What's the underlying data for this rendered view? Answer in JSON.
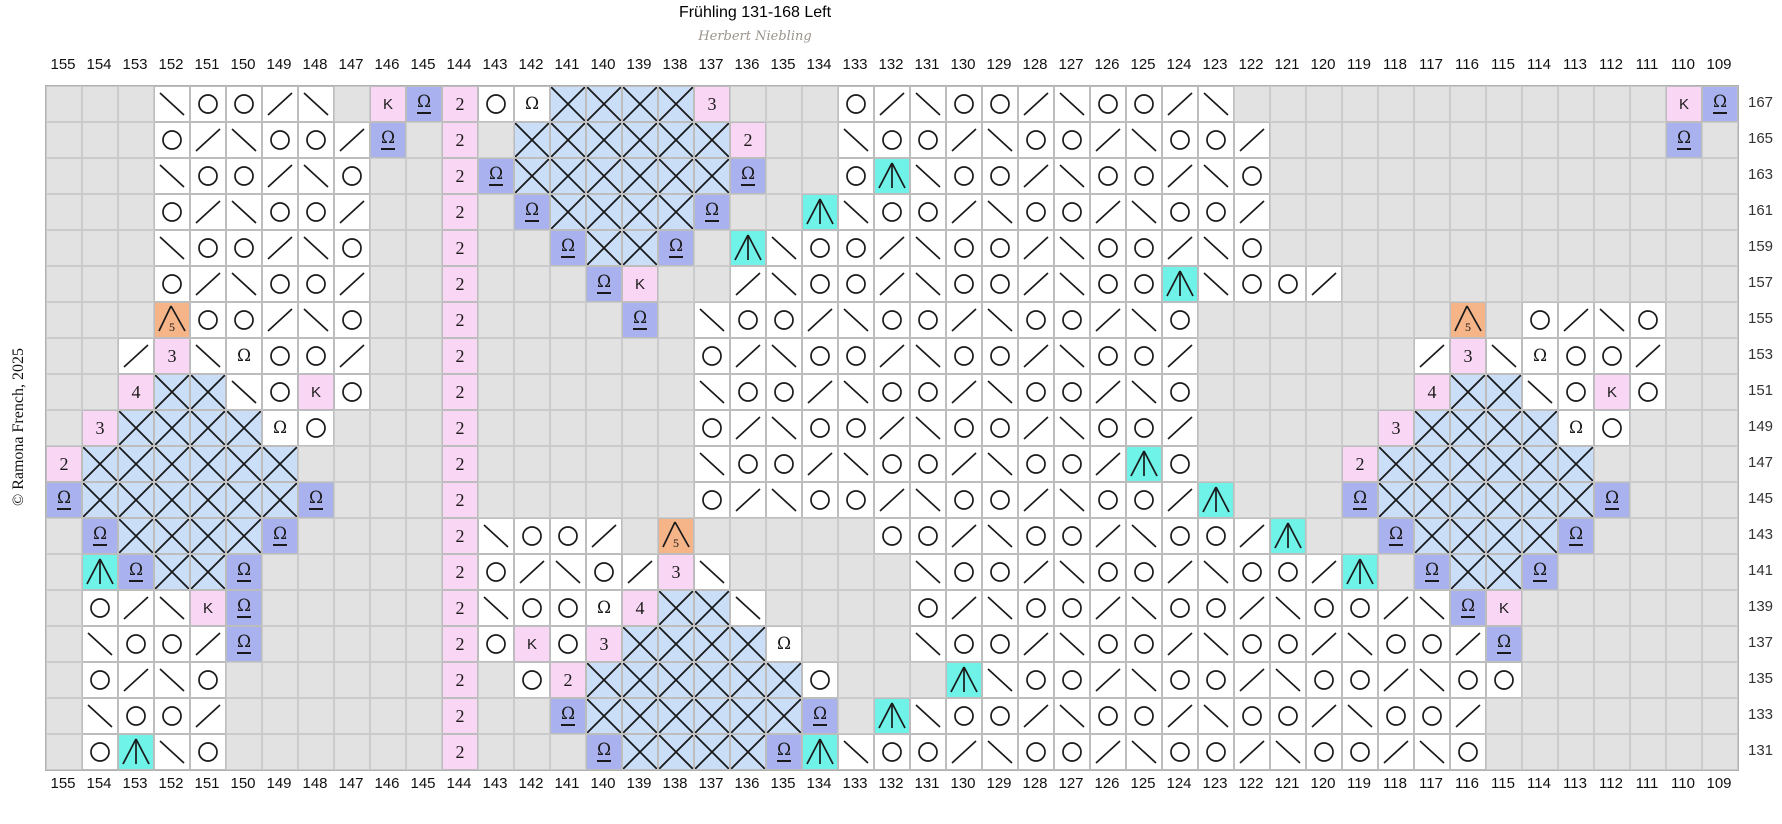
{
  "title": "Frühling 131-168 Left",
  "subtitle": "Herbert Niebling",
  "copyright": "© Ramona French, 2025",
  "chart_data": {
    "type": "heatmap",
    "description": "Lace knitting chart grid; odd-numbered right-side rows 167 down to 131, stitch columns 155 down to 109",
    "columns": [
      155,
      154,
      153,
      152,
      151,
      150,
      149,
      148,
      147,
      146,
      145,
      144,
      143,
      142,
      141,
      140,
      139,
      138,
      137,
      136,
      135,
      134,
      133,
      132,
      131,
      130,
      129,
      128,
      127,
      126,
      125,
      124,
      123,
      122,
      121,
      120,
      119,
      118,
      117,
      116,
      115,
      114,
      113,
      112,
      111,
      110,
      109
    ],
    "row_numbers": [
      167,
      165,
      163,
      161,
      159,
      157,
      155,
      153,
      151,
      149,
      147,
      145,
      143,
      141,
      139,
      137,
      135,
      133,
      131
    ],
    "legend": {
      "g": "no stitch (gray)",
      "bs": "left-leaning decrease \\",
      "fs": "right-leaning decrease /",
      "o": "yarn over O",
      "A": "centered double decrease (cyan)",
      "W": "twisted stitch omega (periwinkle)",
      "Q": "twisted stitch omega (white)",
      "K": "K stitch (pink)",
      "2": "repeat number 2 (pink)",
      "3": "repeat number 3 (pink)",
      "4": "repeat number 4 (pink)",
      "5": "5-into-1 gathered stitch (orange)",
      "X": "crossed-stitch lattice (light blue)"
    },
    "colors": {
      "no_stitch": "#e2e2e2",
      "pink": "#f9d6f3",
      "periwinkle": "#a9b2ee",
      "cyan": "#6ff3e9",
      "orange": "#f6b588",
      "lattice_blue": "#cadef8",
      "stroke": "#1a1a1a",
      "grid_line": "#bdbdbd"
    },
    "rows": [
      [
        "g",
        "g",
        "g",
        "bs",
        "o",
        "o",
        "fs",
        "bs",
        "g",
        "K",
        "W",
        "2",
        "o",
        "Q",
        "X",
        "X",
        "X",
        "X",
        "3",
        "g",
        "g",
        "g",
        "o",
        "fs",
        "bs",
        "o",
        "o",
        "fs",
        "bs",
        "o",
        "o",
        "fs",
        "bs",
        "g",
        "g",
        "g",
        "g",
        "g",
        "g",
        "g",
        "g",
        "g",
        "g",
        "g",
        "g",
        "K",
        "W"
      ],
      [
        "g",
        "g",
        "g",
        "o",
        "fs",
        "bs",
        "o",
        "o",
        "fs",
        "W",
        "g",
        "2",
        "g",
        "X",
        "X",
        "X",
        "X",
        "X",
        "X",
        "2",
        "g",
        "g",
        "bs",
        "o",
        "o",
        "fs",
        "bs",
        "o",
        "o",
        "fs",
        "bs",
        "o",
        "o",
        "fs",
        "g",
        "g",
        "g",
        "g",
        "g",
        "g",
        "g",
        "g",
        "g",
        "g",
        "g",
        "W",
        "g"
      ],
      [
        "g",
        "g",
        "g",
        "bs",
        "o",
        "o",
        "fs",
        "bs",
        "o",
        "g",
        "g",
        "2",
        "W",
        "X",
        "X",
        "X",
        "X",
        "X",
        "X",
        "W",
        "g",
        "g",
        "o",
        "A",
        "bs",
        "o",
        "o",
        "fs",
        "bs",
        "o",
        "o",
        "fs",
        "bs",
        "o",
        "g",
        "g",
        "g",
        "g",
        "g",
        "g",
        "g",
        "g",
        "g",
        "g",
        "g",
        "g",
        "g"
      ],
      [
        "g",
        "g",
        "g",
        "o",
        "fs",
        "bs",
        "o",
        "o",
        "fs",
        "g",
        "g",
        "2",
        "g",
        "W",
        "X",
        "X",
        "X",
        "X",
        "W",
        "g",
        "g",
        "A",
        "bs",
        "o",
        "o",
        "fs",
        "bs",
        "o",
        "o",
        "fs",
        "bs",
        "o",
        "o",
        "fs",
        "g",
        "g",
        "g",
        "g",
        "g",
        "g",
        "g",
        "g",
        "g",
        "g",
        "g",
        "g",
        "g"
      ],
      [
        "g",
        "g",
        "g",
        "bs",
        "o",
        "o",
        "fs",
        "bs",
        "o",
        "g",
        "g",
        "2",
        "g",
        "g",
        "W",
        "X",
        "X",
        "W",
        "g",
        "A",
        "bs",
        "o",
        "o",
        "fs",
        "bs",
        "o",
        "o",
        "fs",
        "bs",
        "o",
        "o",
        "fs",
        "bs",
        "o",
        "g",
        "g",
        "g",
        "g",
        "g",
        "g",
        "g",
        "g",
        "g",
        "g",
        "g",
        "g",
        "g"
      ],
      [
        "g",
        "g",
        "g",
        "o",
        "fs",
        "bs",
        "o",
        "o",
        "fs",
        "g",
        "g",
        "2",
        "g",
        "g",
        "g",
        "W",
        "K",
        "g",
        "g",
        "fs",
        "bs",
        "o",
        "o",
        "fs",
        "bs",
        "o",
        "o",
        "fs",
        "bs",
        "o",
        "o",
        "A",
        "bs",
        "o",
        "o",
        "fs",
        "g",
        "g",
        "g",
        "g",
        "g",
        "g",
        "g",
        "g",
        "g",
        "g",
        "g"
      ],
      [
        "g",
        "g",
        "g",
        "5",
        "o",
        "o",
        "fs",
        "bs",
        "o",
        "g",
        "g",
        "2",
        "g",
        "g",
        "g",
        "g",
        "W",
        "g",
        "bs",
        "o",
        "o",
        "fs",
        "bs",
        "o",
        "o",
        "fs",
        "bs",
        "o",
        "o",
        "fs",
        "bs",
        "o",
        "g",
        "g",
        "g",
        "g",
        "g",
        "g",
        "g",
        "5",
        "g",
        "o",
        "fs",
        "bs",
        "o",
        "g",
        "g"
      ],
      [
        "g",
        "g",
        "fs",
        "3",
        "bs",
        "Q",
        "o",
        "o",
        "fs",
        "g",
        "g",
        "2",
        "g",
        "g",
        "g",
        "g",
        "g",
        "g",
        "o",
        "fs",
        "bs",
        "o",
        "o",
        "fs",
        "bs",
        "o",
        "o",
        "fs",
        "bs",
        "o",
        "o",
        "fs",
        "g",
        "g",
        "g",
        "g",
        "g",
        "g",
        "fs",
        "3",
        "bs",
        "Q",
        "o",
        "o",
        "fs",
        "g",
        "g"
      ],
      [
        "g",
        "g",
        "4",
        "X",
        "X",
        "bs",
        "o",
        "K",
        "o",
        "g",
        "g",
        "2",
        "g",
        "g",
        "g",
        "g",
        "g",
        "g",
        "bs",
        "o",
        "o",
        "fs",
        "bs",
        "o",
        "o",
        "fs",
        "bs",
        "o",
        "o",
        "fs",
        "bs",
        "o",
        "g",
        "g",
        "g",
        "g",
        "g",
        "g",
        "4",
        "X",
        "X",
        "bs",
        "o",
        "K",
        "o",
        "g",
        "g"
      ],
      [
        "g",
        "3",
        "X",
        "X",
        "X",
        "X",
        "Q",
        "o",
        "g",
        "g",
        "g",
        "2",
        "g",
        "g",
        "g",
        "g",
        "g",
        "g",
        "o",
        "fs",
        "bs",
        "o",
        "o",
        "fs",
        "bs",
        "o",
        "o",
        "fs",
        "bs",
        "o",
        "o",
        "fs",
        "g",
        "g",
        "g",
        "g",
        "g",
        "3",
        "X",
        "X",
        "X",
        "X",
        "Q",
        "o",
        "g",
        "g",
        "g"
      ],
      [
        "2",
        "X",
        "X",
        "X",
        "X",
        "X",
        "X",
        "g",
        "g",
        "g",
        "g",
        "2",
        "g",
        "g",
        "g",
        "g",
        "g",
        "g",
        "bs",
        "o",
        "o",
        "fs",
        "bs",
        "o",
        "o",
        "fs",
        "bs",
        "o",
        "o",
        "fs",
        "A",
        "o",
        "g",
        "g",
        "g",
        "g",
        "2",
        "X",
        "X",
        "X",
        "X",
        "X",
        "X",
        "g",
        "g",
        "g",
        "g"
      ],
      [
        "W",
        "X",
        "X",
        "X",
        "X",
        "X",
        "X",
        "W",
        "g",
        "g",
        "g",
        "2",
        "g",
        "g",
        "g",
        "g",
        "g",
        "g",
        "o",
        "fs",
        "bs",
        "o",
        "o",
        "fs",
        "bs",
        "o",
        "o",
        "fs",
        "bs",
        "o",
        "o",
        "fs",
        "A",
        "g",
        "g",
        "g",
        "W",
        "X",
        "X",
        "X",
        "X",
        "X",
        "X",
        "W",
        "g",
        "g",
        "g"
      ],
      [
        "g",
        "W",
        "X",
        "X",
        "X",
        "X",
        "W",
        "g",
        "g",
        "g",
        "g",
        "2",
        "bs",
        "o",
        "o",
        "fs",
        "g",
        "5",
        "g",
        "g",
        "g",
        "g",
        "g",
        "o",
        "o",
        "fs",
        "bs",
        "o",
        "o",
        "fs",
        "bs",
        "o",
        "o",
        "fs",
        "A",
        "g",
        "g",
        "W",
        "X",
        "X",
        "X",
        "X",
        "W",
        "g",
        "g",
        "g",
        "g"
      ],
      [
        "g",
        "A",
        "W",
        "X",
        "X",
        "W",
        "g",
        "g",
        "g",
        "g",
        "g",
        "2",
        "o",
        "fs",
        "bs",
        "o",
        "fs",
        "3",
        "bs",
        "g",
        "g",
        "g",
        "g",
        "g",
        "bs",
        "o",
        "o",
        "fs",
        "bs",
        "o",
        "o",
        "fs",
        "bs",
        "o",
        "o",
        "fs",
        "A",
        "g",
        "W",
        "X",
        "X",
        "W",
        "g",
        "g",
        "g",
        "g",
        "g"
      ],
      [
        "g",
        "o",
        "fs",
        "bs",
        "K",
        "W",
        "g",
        "g",
        "g",
        "g",
        "g",
        "2",
        "bs",
        "o",
        "o",
        "Q",
        "4",
        "X",
        "X",
        "bs",
        "g",
        "g",
        "g",
        "g",
        "o",
        "fs",
        "bs",
        "o",
        "o",
        "fs",
        "bs",
        "o",
        "o",
        "fs",
        "bs",
        "o",
        "o",
        "fs",
        "bs",
        "W",
        "K",
        "g",
        "g",
        "g",
        "g",
        "g",
        "g"
      ],
      [
        "g",
        "bs",
        "o",
        "o",
        "fs",
        "W",
        "g",
        "g",
        "g",
        "g",
        "g",
        "2",
        "o",
        "K",
        "o",
        "3",
        "X",
        "X",
        "X",
        "X",
        "Q",
        "g",
        "g",
        "g",
        "bs",
        "o",
        "o",
        "fs",
        "bs",
        "o",
        "o",
        "fs",
        "bs",
        "o",
        "o",
        "fs",
        "bs",
        "o",
        "o",
        "fs",
        "W",
        "g",
        "g",
        "g",
        "g",
        "g",
        "g"
      ],
      [
        "g",
        "o",
        "fs",
        "bs",
        "o",
        "g",
        "g",
        "g",
        "g",
        "g",
        "g",
        "2",
        "g",
        "o",
        "2",
        "X",
        "X",
        "X",
        "X",
        "X",
        "X",
        "o",
        "g",
        "g",
        "g",
        "A",
        "bs",
        "o",
        "o",
        "fs",
        "bs",
        "o",
        "o",
        "fs",
        "bs",
        "o",
        "o",
        "fs",
        "bs",
        "o",
        "o",
        "g",
        "g",
        "g",
        "g",
        "g",
        "g"
      ],
      [
        "g",
        "bs",
        "o",
        "o",
        "fs",
        "g",
        "g",
        "g",
        "g",
        "g",
        "g",
        "2",
        "g",
        "g",
        "W",
        "X",
        "X",
        "X",
        "X",
        "X",
        "X",
        "W",
        "g",
        "A",
        "bs",
        "o",
        "o",
        "fs",
        "bs",
        "o",
        "o",
        "fs",
        "bs",
        "o",
        "o",
        "fs",
        "bs",
        "o",
        "o",
        "fs",
        "g",
        "g",
        "g",
        "g",
        "g",
        "g",
        "g"
      ],
      [
        "g",
        "o",
        "A",
        "bs",
        "o",
        "g",
        "g",
        "g",
        "g",
        "g",
        "g",
        "2",
        "g",
        "g",
        "g",
        "W",
        "X",
        "X",
        "X",
        "X",
        "W",
        "A",
        "bs",
        "o",
        "o",
        "fs",
        "bs",
        "o",
        "o",
        "fs",
        "bs",
        "o",
        "o",
        "fs",
        "bs",
        "o",
        "o",
        "fs",
        "bs",
        "o",
        "g",
        "g",
        "g",
        "g",
        "g",
        "g",
        "g"
      ]
    ]
  }
}
